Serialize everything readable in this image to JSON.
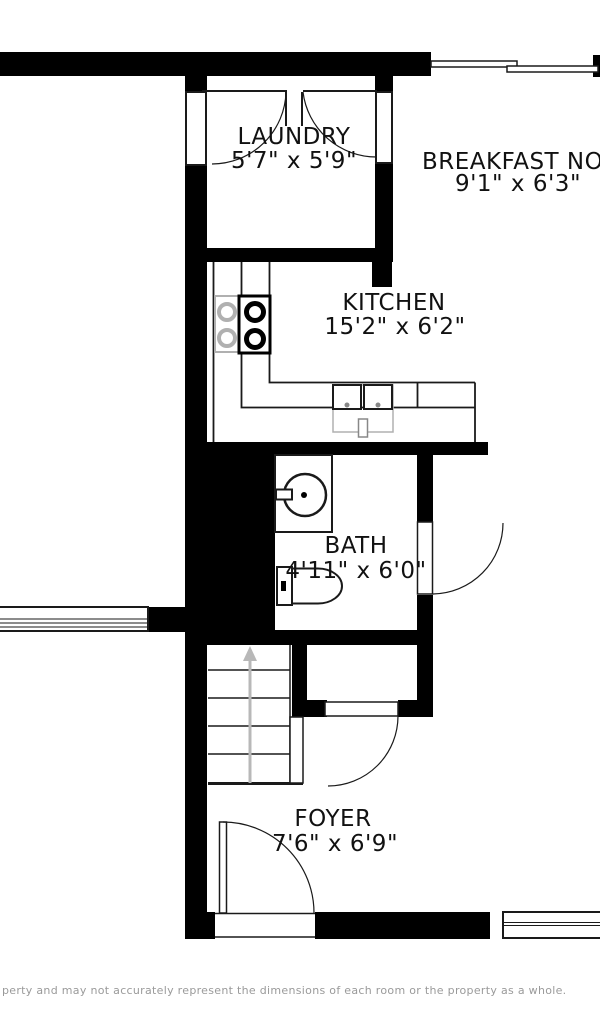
{
  "rooms": {
    "laundry": {
      "name": "LAUNDRY",
      "dims": "5'7\" x 5'9\""
    },
    "breakfast_nook": {
      "name": "BREAKFAST NOOK",
      "dims": "9'1\" x 6'3\""
    },
    "kitchen": {
      "name": "KITCHEN",
      "dims": "15'2\" x 6'2\""
    },
    "bath": {
      "name": "BATH",
      "dims": "4'11\" x 6'0\""
    },
    "foyer": {
      "name": "FOYER",
      "dims": "7'6\" x 6'9\""
    }
  },
  "fixtures": [
    "stove-cooktop",
    "kitchen-double-sink",
    "bath-pedestal-sink",
    "toilet",
    "stairs-up-arrow"
  ],
  "doors": [
    "laundry-double-door",
    "bath-door",
    "foyer-closet-door",
    "front-entry-door"
  ],
  "windows": [
    "top-sliding-window",
    "laundry-left-window",
    "laundry-right-window",
    "left-exterior-window",
    "bottom-front-window"
  ],
  "stairs": {
    "direction": "up"
  },
  "disclaimer": "perty and may not accurately represent the dimensions of each room or the property as a whole.",
  "colors": {
    "wall": "#000000",
    "line": "#1a1a1a",
    "fixture_gray": "#b0b0b0",
    "arrow_gray": "#b8b8b8",
    "text": "#111111",
    "disclaimer_text": "#9a9a9a",
    "background": "#ffffff"
  }
}
